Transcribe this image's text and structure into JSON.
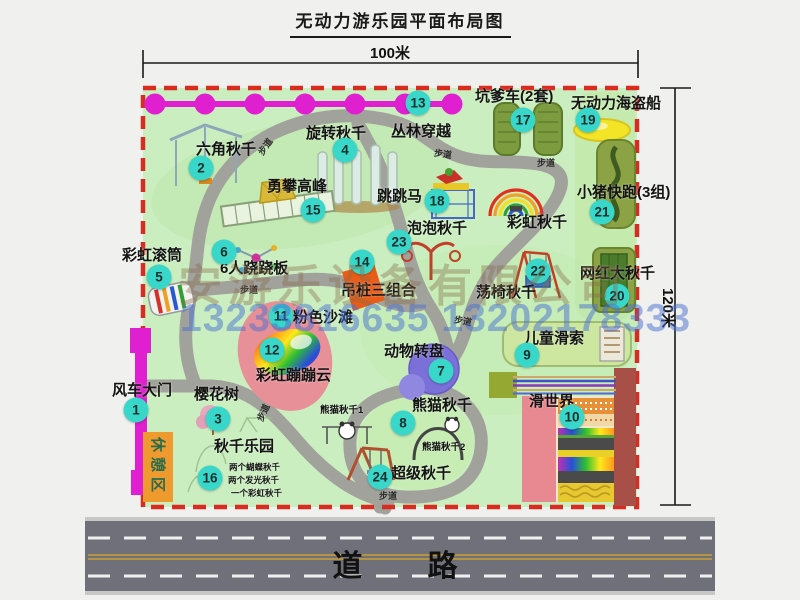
{
  "title": "无动力游乐园平面布局图",
  "dimensions": {
    "width_label": "100米",
    "height_label": "120米"
  },
  "road": {
    "label": "道   路"
  },
  "rest_area": {
    "label": "休憩区"
  },
  "path_label_text": "步道",
  "watermark": {
    "company": "安游乐设备有限公司",
    "phone": "13233816635 13202178333"
  },
  "colors": {
    "park_green": "#cbeec0",
    "border_red": "#d92b1f",
    "path_gray": "#a2a29c",
    "chain_magenta": "#e020d0",
    "badge_teal": "#38d7c9",
    "road_gray": "#70707a",
    "rest_orange": "#ef9a2e",
    "gate_magenta": "#e020d0"
  },
  "attractions": [
    {
      "n": "1",
      "t": "风车大门",
      "bx": 136,
      "by": 410,
      "lx": 112,
      "ly": 383
    },
    {
      "n": "2",
      "t": "六角秋千",
      "bx": 201,
      "by": 168,
      "lx": 196,
      "ly": 142
    },
    {
      "n": "3",
      "t": "樱花树",
      "bx": 218,
      "by": 419,
      "lx": 194,
      "ly": 387
    },
    {
      "n": "4",
      "t": "旋转秋千",
      "bx": 345,
      "by": 150,
      "lx": 306,
      "ly": 126
    },
    {
      "n": "5",
      "t": "彩虹滚筒",
      "bx": 159,
      "by": 277,
      "lx": 122,
      "ly": 248
    },
    {
      "n": "6",
      "t": "6人跷跷板",
      "bx": 224,
      "by": 252,
      "lx": 220,
      "ly": 261
    },
    {
      "n": "7",
      "t": "动物转盘",
      "bx": 441,
      "by": 371,
      "lx": 384,
      "ly": 344
    },
    {
      "n": "8",
      "t": "熊猫秋千",
      "bx": 403,
      "by": 423,
      "lx": 412,
      "ly": 398
    },
    {
      "n": "9",
      "t": "儿童滑索",
      "bx": 527,
      "by": 355,
      "lx": 524,
      "ly": 331
    },
    {
      "n": "10",
      "t": "滑世界",
      "bx": 572,
      "by": 417,
      "lx": 529,
      "ly": 394
    },
    {
      "n": "11",
      "t": "粉色沙滩",
      "bx": 281,
      "by": 316,
      "lx": 293,
      "ly": 310
    },
    {
      "n": "12",
      "t": "彩虹蹦蹦云",
      "bx": 272,
      "by": 350,
      "lx": 256,
      "ly": 368
    },
    {
      "n": "13",
      "t": "丛林穿越",
      "bx": 418,
      "by": 103,
      "lx": 391,
      "ly": 124
    },
    {
      "n": "14",
      "t": "吊桩三组合",
      "bx": 362,
      "by": 262,
      "lx": 341,
      "ly": 283
    },
    {
      "n": "15",
      "t": "勇攀高峰",
      "bx": 313,
      "by": 210,
      "lx": 267,
      "ly": 179
    },
    {
      "n": "16",
      "t": "秋千乐园",
      "bx": 210,
      "by": 478,
      "lx": 214,
      "ly": 439
    },
    {
      "n": "17",
      "t": "坑爹车(2套)",
      "bx": 523,
      "by": 120,
      "lx": 475,
      "ly": 89
    },
    {
      "n": "18",
      "t": "跳跳马",
      "bx": 437,
      "by": 201,
      "lx": 377,
      "ly": 189
    },
    {
      "n": "19",
      "t": "无动力海盗船",
      "bx": 588,
      "by": 120,
      "lx": 571,
      "ly": 96
    },
    {
      "n": "20",
      "t": "网红大秋千",
      "bx": 617,
      "by": 296,
      "lx": 580,
      "ly": 266
    },
    {
      "n": "21",
      "t": "小猪快跑(3组)",
      "bx": 602,
      "by": 212,
      "lx": 577,
      "ly": 185
    },
    {
      "n": "22",
      "t": "荡椅秋千",
      "bx": 538,
      "by": 271,
      "lx": 476,
      "ly": 285
    },
    {
      "n": "23",
      "t": "泡泡秋千",
      "bx": 399,
      "by": 242,
      "lx": 407,
      "ly": 221
    },
    {
      "n": "24",
      "t": "超级秋千",
      "bx": 380,
      "by": 477,
      "lx": 391,
      "ly": 466
    },
    {
      "n": "",
      "t": "彩虹秋千",
      "lx": 507,
      "ly": 215
    },
    {
      "n": "",
      "t": "熊猫秋千1",
      "lx": 320,
      "ly": 406,
      "c": "small"
    },
    {
      "n": "",
      "t": "熊猫秋千2",
      "lx": 422,
      "ly": 443,
      "c": "small"
    },
    {
      "n": "",
      "t": "两个蝴蝶秋千",
      "lx": 229,
      "ly": 463,
      "c": "tiny"
    },
    {
      "n": "",
      "t": "两个发光秋千",
      "lx": 228,
      "ly": 476,
      "c": "tiny"
    },
    {
      "n": "",
      "t": "一个彩虹秋千",
      "lx": 231,
      "ly": 489,
      "c": "tiny"
    }
  ],
  "path_labels": [
    {
      "x": 256,
      "y": 140,
      "r": -55
    },
    {
      "x": 434,
      "y": 147,
      "r": 8
    },
    {
      "x": 537,
      "y": 156,
      "r": 0
    },
    {
      "x": 240,
      "y": 283,
      "r": 0
    },
    {
      "x": 254,
      "y": 406,
      "r": -65
    },
    {
      "x": 454,
      "y": 314,
      "r": 10
    },
    {
      "x": 379,
      "y": 489,
      "r": 0
    }
  ]
}
